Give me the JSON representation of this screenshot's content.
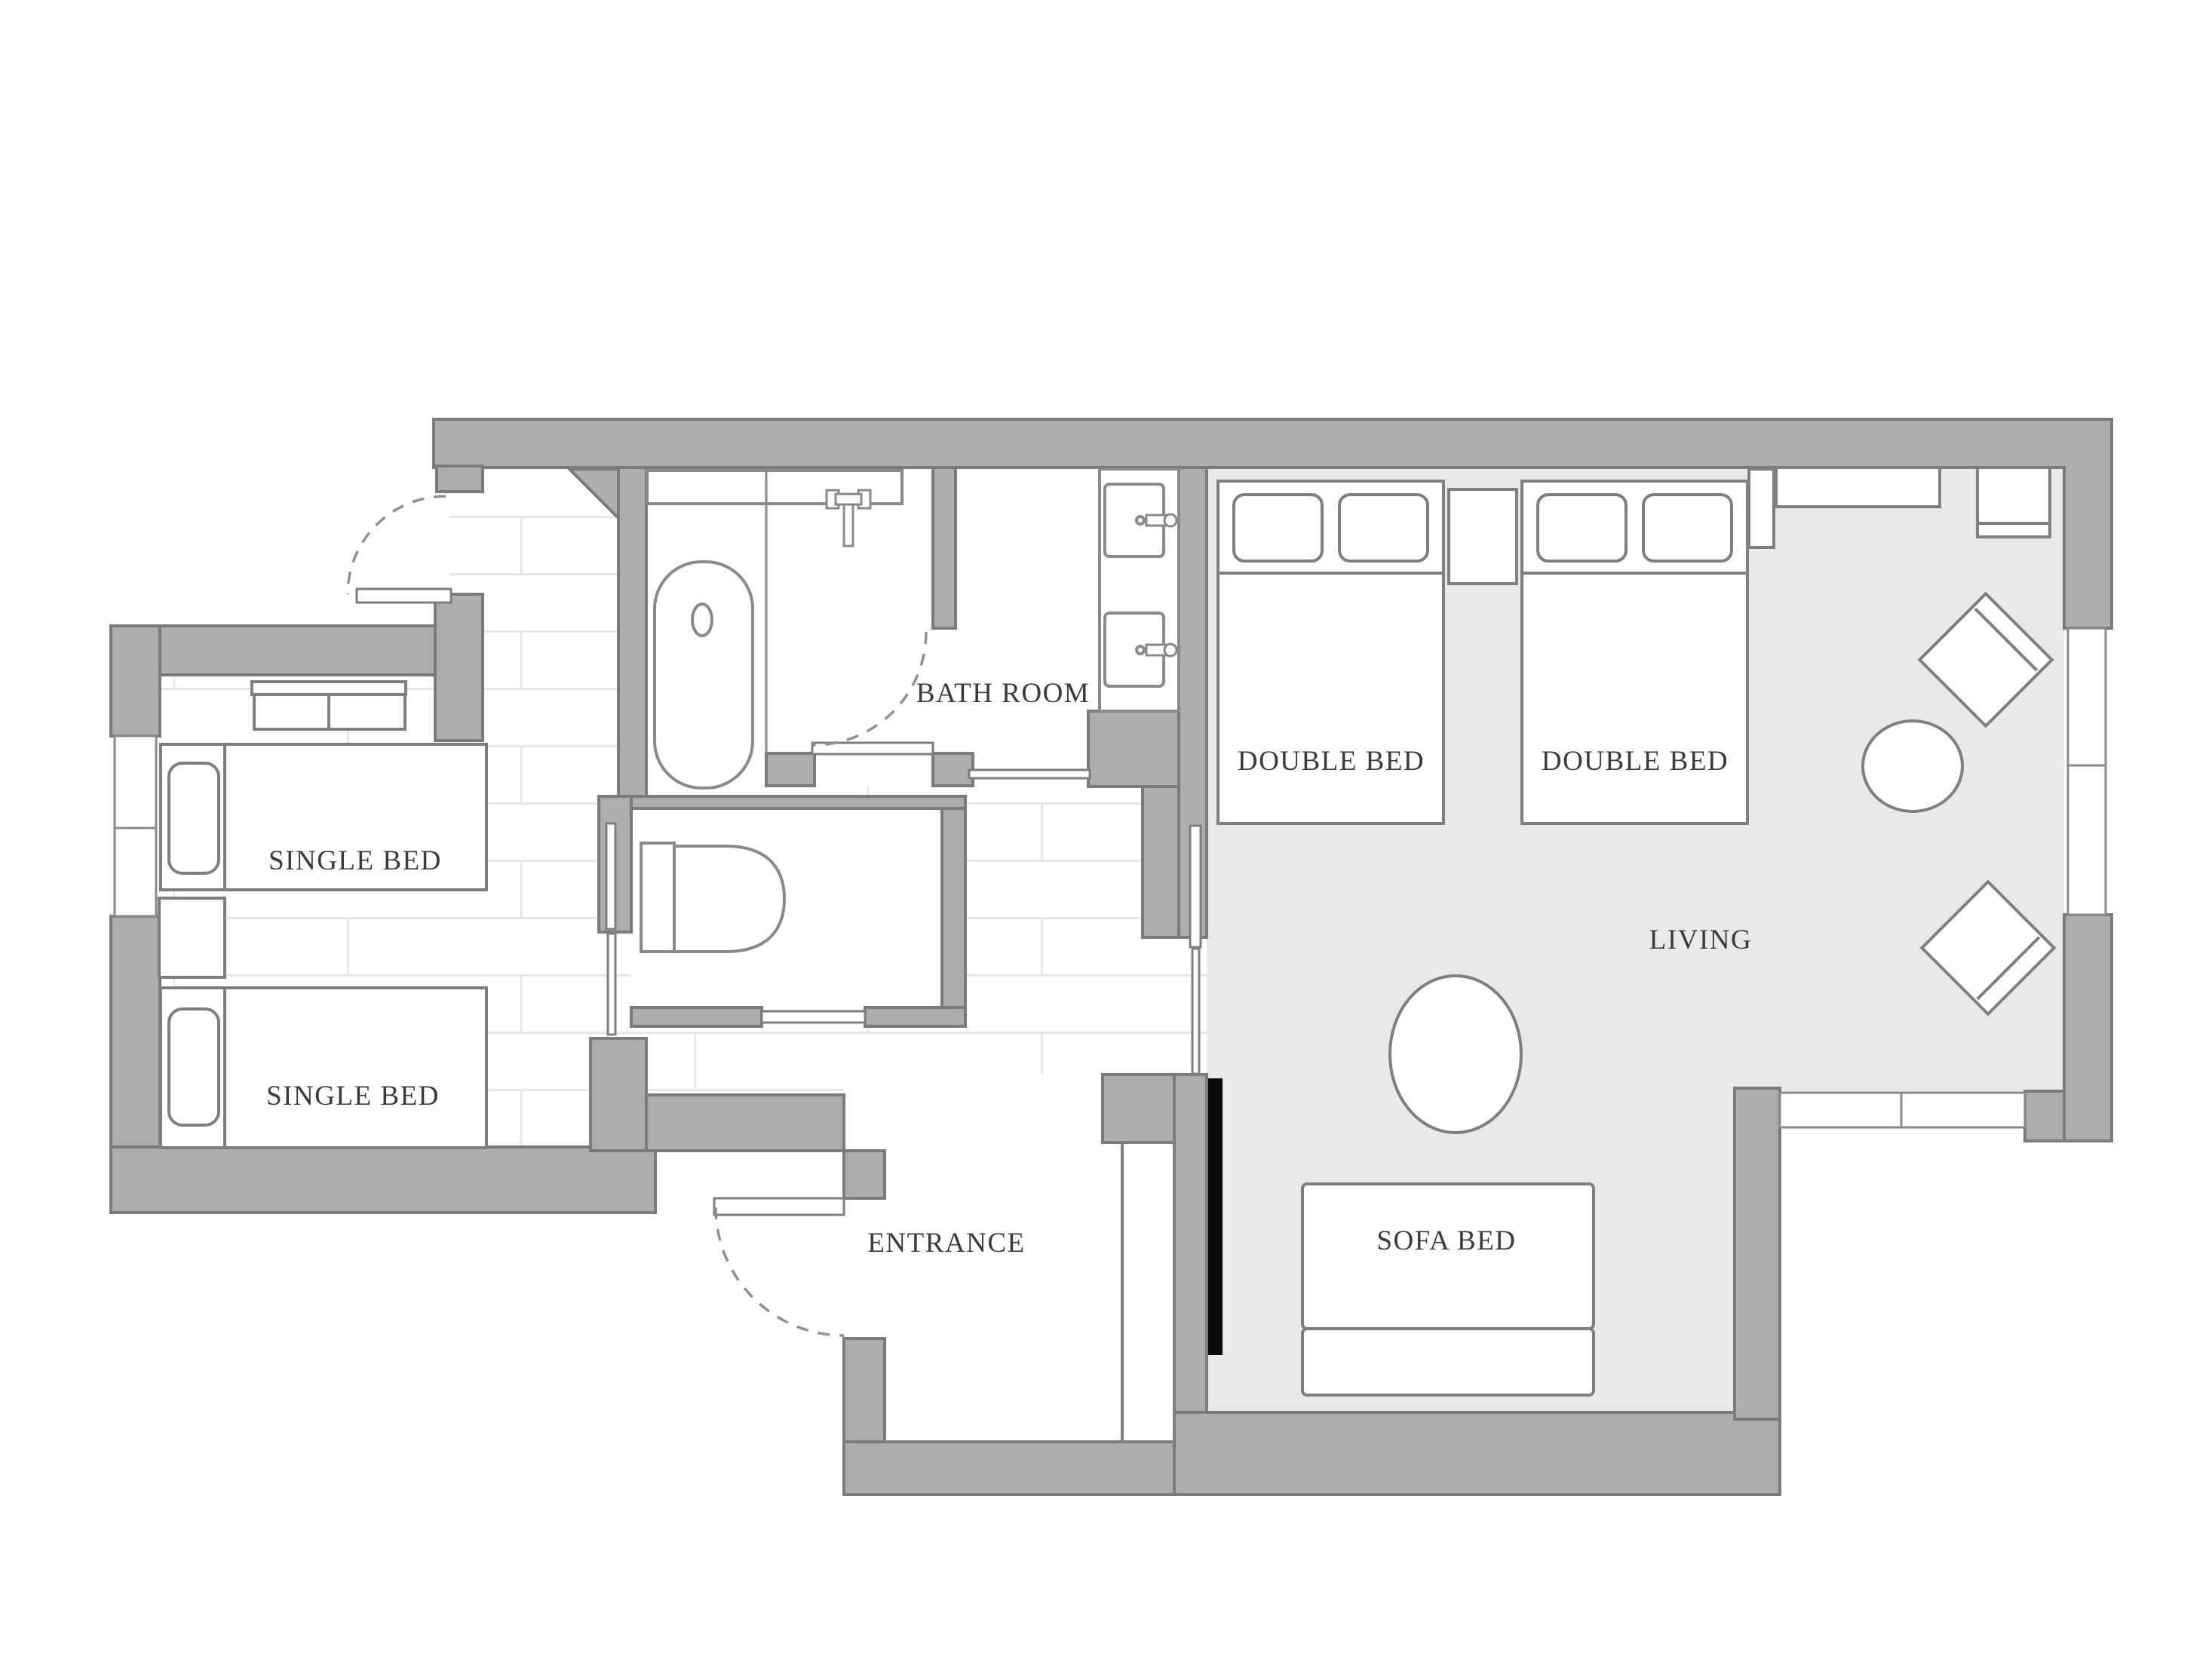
{
  "plan": {
    "type": "apartment-floor-plan",
    "labels": {
      "single_bed_1": "SINGLE BED",
      "single_bed_2": "SINGLE BED",
      "bath_room": "BATH ROOM",
      "double_bed_1": "DOUBLE BED",
      "double_bed_2": "DOUBLE BED",
      "living": "LIVING",
      "sofa_bed": "SOFA BED",
      "entrance": "ENTRANCE"
    },
    "colors": {
      "wall_fill": "#adadad",
      "wall_stroke": "#7b7b7b",
      "furniture_stroke": "#7f7f7f",
      "fixture_stroke": "#8a8a8a",
      "living_floor": "#e9e9e9",
      "tile_line": "#e7e7e7",
      "label_text": "#3b3b3b",
      "tv_panel": "#0a0a0a",
      "floor_white": "#ffffff"
    },
    "symbols": {
      "bed": "white rectangle with headboard line and rounded pillow",
      "bathtub": "stadium-shaped tub with drain ellipse",
      "shower_fixture": "T-shaped valve on wall niche",
      "sink": "square basin with side faucet",
      "toilet": "tank plus D-shaped bowl",
      "swing_door": "door leaf with dashed quarter-circle arc",
      "sliding_door": "thin white bar in wall opening",
      "window": "white strip in wall with divider line",
      "lounge_chair": "45-degree rotated square with backrest line",
      "round_table": "white ellipse",
      "sofa_bed": "back rectangle plus seat rectangle",
      "tv_panel": "solid black wall bar",
      "nightstand": "small white rectangle",
      "headboard_console": "shelf with two drawers"
    },
    "counts": {
      "single_beds": 2,
      "double_beds": 2,
      "sofa_beds": 1,
      "lounge_chairs": 2,
      "tables": 2,
      "sinks": 2,
      "windows": 3,
      "swing_doors": 3,
      "sliding_doors": 4
    }
  }
}
